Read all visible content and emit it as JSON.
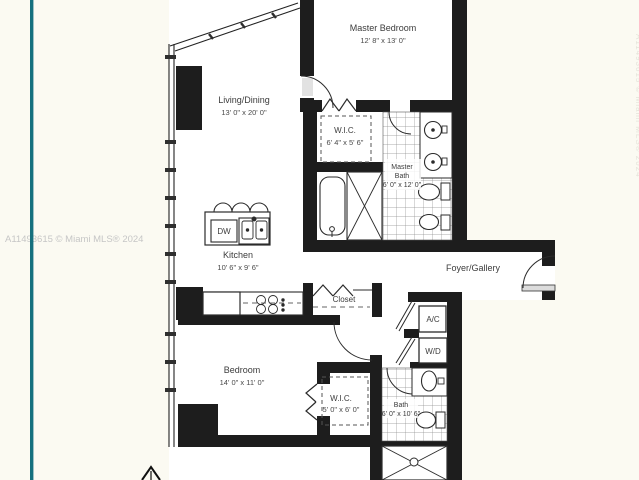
{
  "watermark": {
    "left": "A11493615 © Miami MLS® 2024",
    "right": "A11493615 © Miami MLS® 2024"
  },
  "colors": {
    "accent_teal": "#15707e",
    "wall_black": "#1d1d1d",
    "watermark_gray": "#c6c6c6",
    "paper": "#fbfaf2"
  },
  "plan": {
    "rooms": {
      "master_bedroom": {
        "name": "Master Bedroom",
        "dims": "12' 8\" x 13' 0\""
      },
      "living_dining": {
        "name": "Living/Dining",
        "dims": "13' 0\" x 20' 0\""
      },
      "master_wic": {
        "name": "W.I.C.",
        "dims": "6' 4\" x 5' 6\""
      },
      "master_bath": {
        "line1": "Master",
        "line2": "Bath",
        "dims": "6' 0\" x 12' 0\""
      },
      "kitchen": {
        "name": "Kitchen",
        "dims": "10' 6\" x 9' 6\""
      },
      "foyer": {
        "name": "Foyer/Gallery"
      },
      "closet": {
        "name": "Closet"
      },
      "bedroom": {
        "name": "Bedroom",
        "dims": "14' 0\" x 11' 0\""
      },
      "bedroom_wic": {
        "name": "W.I.C.",
        "dims": "5' 0\" x 6' 0\""
      },
      "bath": {
        "name": "Bath",
        "dims": "6' 0\" x 10' 6\""
      }
    },
    "labels": {
      "dishwasher": "DW",
      "ac": "A/C",
      "washer_dryer": "W/D"
    }
  }
}
